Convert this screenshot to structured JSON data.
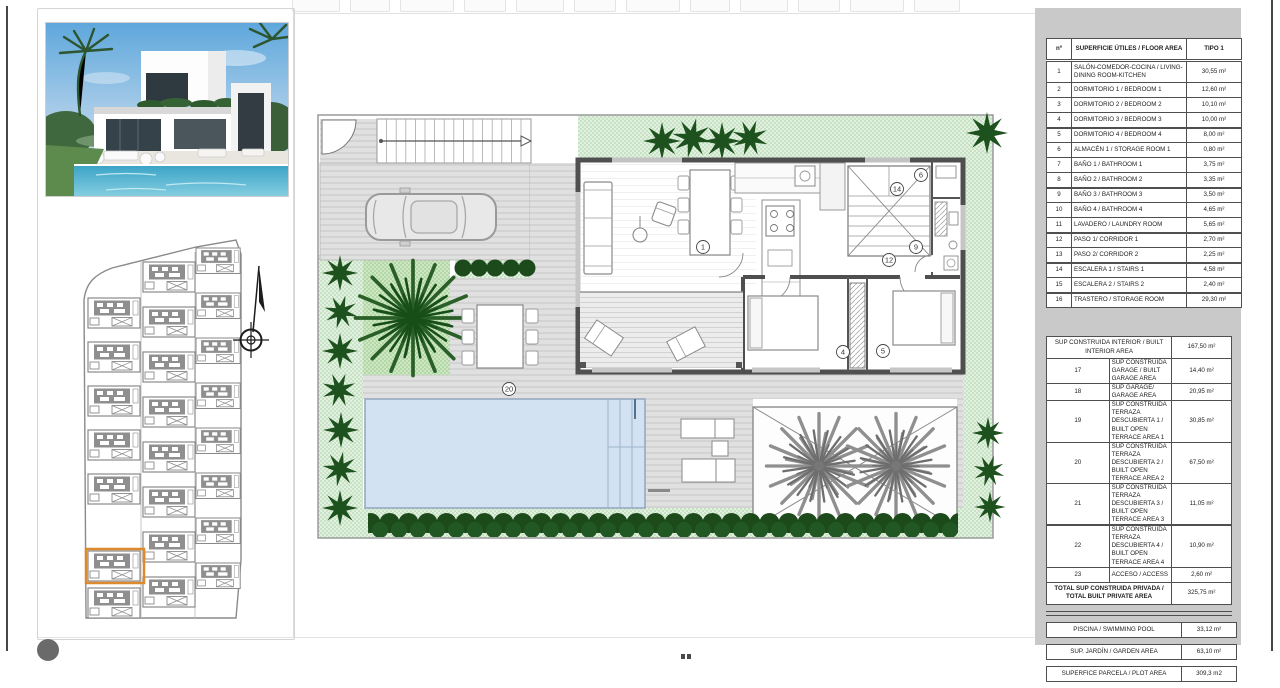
{
  "page": {
    "panel_gray": "#c9c9c9",
    "accent_orange": "#dd8a2e",
    "garden_green": "#c7e2c5",
    "tree_green": "#1d511d",
    "pool_blue": "#d2e2f2",
    "wall_gray": "#4f4f4f"
  },
  "floor_plan": {
    "labels": [
      "1",
      "4",
      "5",
      "6",
      "9",
      "12",
      "14",
      "20"
    ]
  },
  "area_table": {
    "header": {
      "col_num": "nº",
      "col_name": "SUPERFICIE ÚTILES / FLOOR AREA",
      "col_value": "TIPO 1"
    },
    "rows": [
      {
        "num": "1",
        "name": "SALÓN-COMEDOR-COCINA / LIVING-DINING ROOM-KITCHEN",
        "value": "30,55 m²",
        "cls": "h2"
      },
      {
        "num": "2",
        "name": "DORMITORIO 1 / BEDROOM 1",
        "value": "12,60 m²",
        "cls": ""
      },
      {
        "num": "3",
        "name": "DORMITORIO 2 / BEDROOM 2",
        "value": "10,10 m²",
        "cls": ""
      },
      {
        "num": "4",
        "name": "DORMITORIO 3 / BEDROOM 3",
        "value": "10,00 m²",
        "cls": ""
      },
      {
        "num": "5",
        "name": "DORMITORIO 4 / BEDROOM 4",
        "value": "8,00 m²",
        "cls": "heavy"
      },
      {
        "num": "6",
        "name": "ALMACÉN 1 / STORAGE ROOM 1",
        "value": "0,80 m²",
        "cls": ""
      },
      {
        "num": "7",
        "name": "BAÑO 1 / BATHROOM 1",
        "value": "3,75 m²",
        "cls": ""
      },
      {
        "num": "8",
        "name": "BAÑO 2 / BATHROOM 2",
        "value": "3,35 m²",
        "cls": ""
      },
      {
        "num": "9",
        "name": "BAÑO 3 / BATHROOM 3",
        "value": "3,50 m²",
        "cls": "heavy"
      },
      {
        "num": "10",
        "name": "BAÑO 4 / BATHROOM 4",
        "value": "4,65 m²",
        "cls": ""
      },
      {
        "num": "11",
        "name": "LAVADERO / LAUNDRY ROOM",
        "value": "5,65 m²",
        "cls": ""
      },
      {
        "num": "12",
        "name": "PASO 1/ CORRIDOR 1",
        "value": "2,70 m²",
        "cls": "heavy"
      },
      {
        "num": "13",
        "name": "PASO 2/ CORRIDOR 2",
        "value": "2,25 m²",
        "cls": ""
      },
      {
        "num": "14",
        "name": "ESCALERA 1 / STAIRS 1",
        "value": "4,58 m²",
        "cls": "heavy"
      },
      {
        "num": "15",
        "name": "ESCALERA 2 / STAIRS 2",
        "value": "2,40 m²",
        "cls": ""
      },
      {
        "num": "16",
        "name": "TRASTERO / STORAGE ROOM",
        "value": "29,30 m²",
        "cls": "heavy"
      }
    ],
    "built_interior": {
      "name": "SUP CONSTRUIDA INTERIOR / BUILT INTERIOR AREA",
      "value": "167,50 m²"
    },
    "rows2": [
      {
        "num": "17",
        "name": "SUP CONSTRUIDA GARAGE / BUILT GARAGE AREA",
        "value": "14,40 m²",
        "cls": "h2"
      },
      {
        "num": "18",
        "name": "SUP GARAGE/ GARAGE AREA",
        "value": "20,95 m²",
        "cls": ""
      },
      {
        "num": "19",
        "name": "SUP CONSTRUIDA TERRAZA DESCUBIERTA 1 / BUILT OPEN TERRACE AREA 1",
        "value": "30,85 m²",
        "cls": "h3"
      },
      {
        "num": "20",
        "name": "SUP CONSTRUIDA TERRAZA DESCUBIERTA 2 / BUILT OPEN TERRACE AREA 2",
        "value": "67,50 m²",
        "cls": "h3"
      },
      {
        "num": "21",
        "name": "SUP CONSTRUIDA TERRAZA DESCUBIERTA 3 / BUILT OPEN TERRACE AREA 3",
        "value": "11,05 m²",
        "cls": "h3"
      },
      {
        "num": "22",
        "name": "SUP CONSTRUIDA TERRAZA DESCUBIERTA 4 / BUILT OPEN TERRACE AREA 4",
        "value": "10,90 m²",
        "cls": "h3 heavy"
      },
      {
        "num": "23",
        "name": "ACCESO / ACCESS",
        "value": "2,60 m²",
        "cls": ""
      }
    ],
    "total": {
      "name": "TOTAL SUP CONSTRUIDA PRIVADA / TOTAL BUILT PRIVATE AREA",
      "value": "325,75 m²"
    },
    "extras": [
      {
        "name": "PISCINA / SWIMMING POOL",
        "value": "33,12 m²"
      },
      {
        "name": "SUP. JARDÍN / GARDEN AREA",
        "value": "63,10 m²"
      },
      {
        "name": "SUPERFICE PARCELA / PLOT AREA",
        "value": "309,3 m2"
      }
    ]
  }
}
